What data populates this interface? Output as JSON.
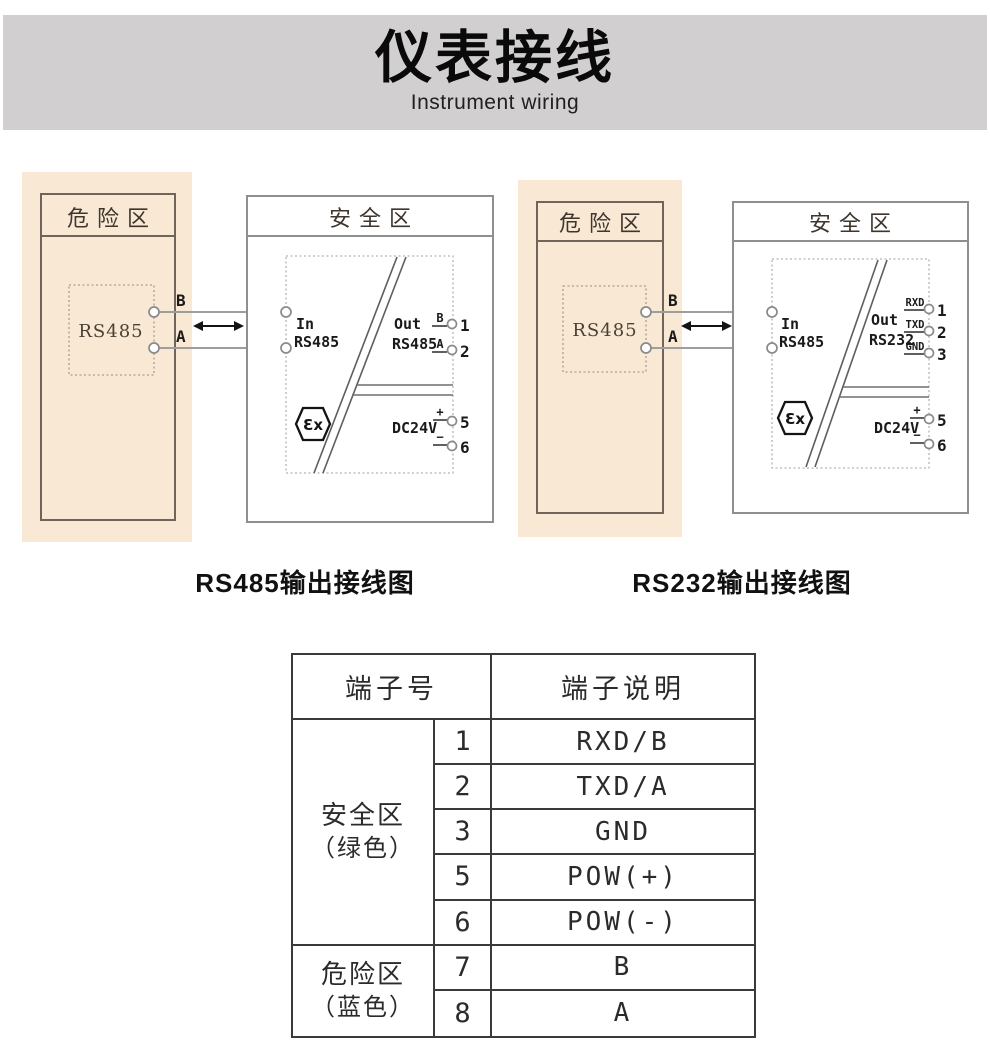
{
  "banner": {
    "title": "仪表接线",
    "subtitle": "Instrument wiring"
  },
  "diagrams": [
    {
      "caption": "RS485输出接线图",
      "hazard_zone_label": "危险区",
      "safe_zone_label": "安全区",
      "device_label": "RS485",
      "wire_labels": {
        "top": "B",
        "bottom": "A"
      },
      "in_terminals": {
        "top": "7",
        "bottom": "8"
      },
      "in_label": {
        "line1": "In",
        "line2": "RS485"
      },
      "out_label": {
        "line1": "Out",
        "line2": "RS485"
      },
      "out_terminals": [
        {
          "label": "B",
          "num": "1"
        },
        {
          "label": "A",
          "num": "2"
        }
      ],
      "power": {
        "label": "DC24V",
        "plus": "+",
        "minus": "−",
        "plus_num": "5",
        "minus_num": "6"
      },
      "ex_mark": "Ɛx"
    },
    {
      "caption": "RS232输出接线图",
      "hazard_zone_label": "危险区",
      "safe_zone_label": "安全区",
      "device_label": "RS485",
      "wire_labels": {
        "top": "B",
        "bottom": "A"
      },
      "in_terminals": {
        "top": "7",
        "bottom": "8"
      },
      "in_label": {
        "line1": "In",
        "line2": "RS485"
      },
      "out_label": {
        "line1": "Out",
        "line2": "RS232"
      },
      "out_terminals": [
        {
          "label": "RXD",
          "num": "1"
        },
        {
          "label": "TXD",
          "num": "2"
        },
        {
          "label": "GND",
          "num": "3"
        }
      ],
      "power": {
        "label": "DC24V",
        "plus": "+",
        "minus": "−",
        "plus_num": "5",
        "minus_num": "6"
      },
      "ex_mark": "Ɛx"
    }
  ],
  "table": {
    "headers": {
      "terminal_no": "端子号",
      "terminal_desc": "端子说明"
    },
    "groups": [
      {
        "zone_line1": "安全区",
        "zone_line2": "（绿色）",
        "rows": [
          [
            "1",
            "RXD/B"
          ],
          [
            "2",
            "TXD/A"
          ],
          [
            "3",
            "GND"
          ],
          [
            "5",
            "POW(+)"
          ],
          [
            "6",
            "POW(-)"
          ]
        ]
      },
      {
        "zone_line1": "危险区",
        "zone_line2": "（蓝色）",
        "rows": [
          [
            "7",
            "B"
          ],
          [
            "8",
            "A"
          ]
        ]
      }
    ]
  },
  "colors": {
    "banner_bg": "#d1cfd0",
    "hazard_area_bg": "#f8e8d4",
    "table_border": "#3a3a3a",
    "wire": "#9e9e9e"
  }
}
